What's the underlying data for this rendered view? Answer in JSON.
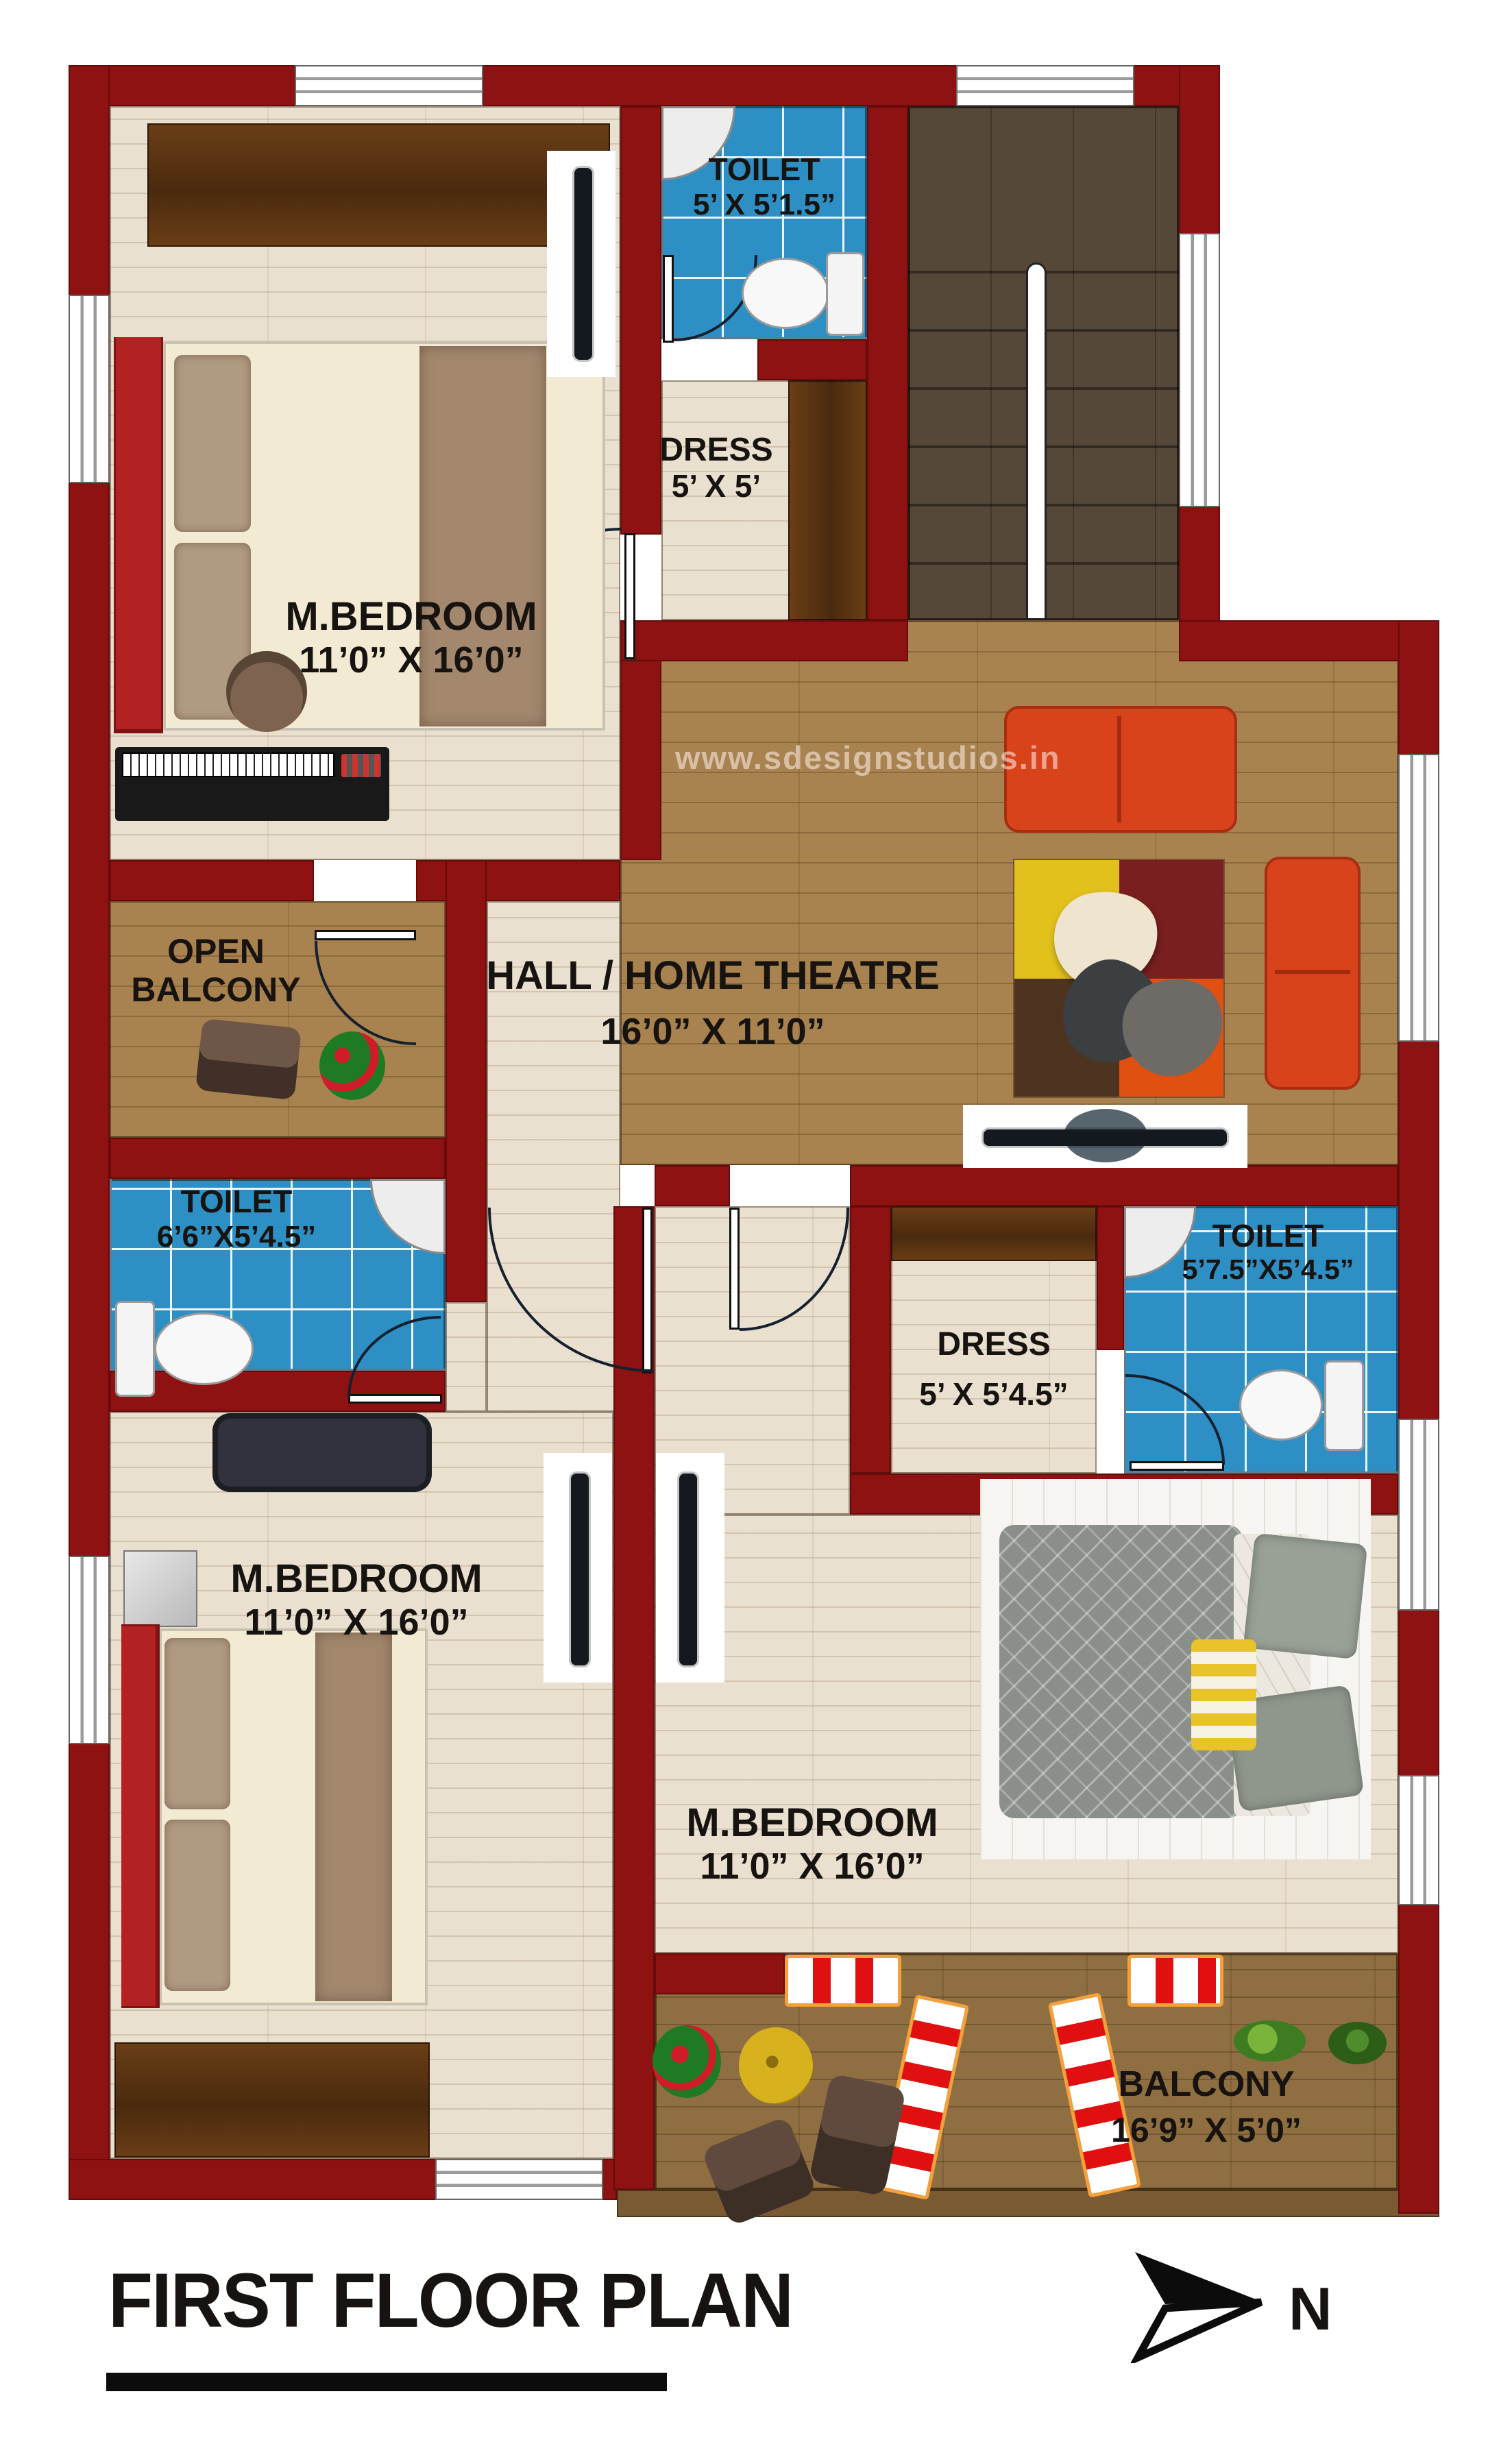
{
  "title": "FIRST FLOOR PLAN",
  "watermark": "www.sdesignstudios.in",
  "compass": {
    "letter": "N"
  },
  "rooms": {
    "bedroom_top_left": {
      "name": "M.BEDROOM",
      "dims": "11’0” X 16’0”"
    },
    "toilet_top": {
      "name": "TOILET",
      "dims": "5’ X 5’1.5”"
    },
    "dress_top": {
      "name": "DRESS",
      "dims": "5’ X 5’"
    },
    "hall": {
      "name": "HALL / HOME THEATRE",
      "dims": "16’0” X 11’0”"
    },
    "open_balcony": {
      "name_line1": "OPEN",
      "name_line2": "BALCONY"
    },
    "toilet_left": {
      "name": "TOILET",
      "dims": "6’6”X5’4.5”"
    },
    "dress_right": {
      "name": "DRESS",
      "dims": "5’ X 5’4.5”"
    },
    "toilet_right": {
      "name": "TOILET",
      "dims": "5’7.5”X5’4.5”"
    },
    "bedroom_bottom_left": {
      "name": "M.BEDROOM",
      "dims": "11’0” X 16’0”"
    },
    "bedroom_bottom_right": {
      "name": "M.BEDROOM",
      "dims": "11’0” X 16’0”"
    },
    "balcony": {
      "name": "BALCONY",
      "dims": "16’9” X 5’0”"
    }
  },
  "colors": {
    "wall": "#8e1212",
    "tile": "#2e8fc4",
    "floorLight": "#eae0cf",
    "floorHall": "#a8824f",
    "floorBalcony": "#8f6f42",
    "stair": "#564839",
    "wardrobe": "#5b3517",
    "sofa": "#d8431c",
    "sofaNavy": "#31323e",
    "bedRed": "#b22222",
    "deck": "#7a5a33",
    "ink": "#171310"
  }
}
